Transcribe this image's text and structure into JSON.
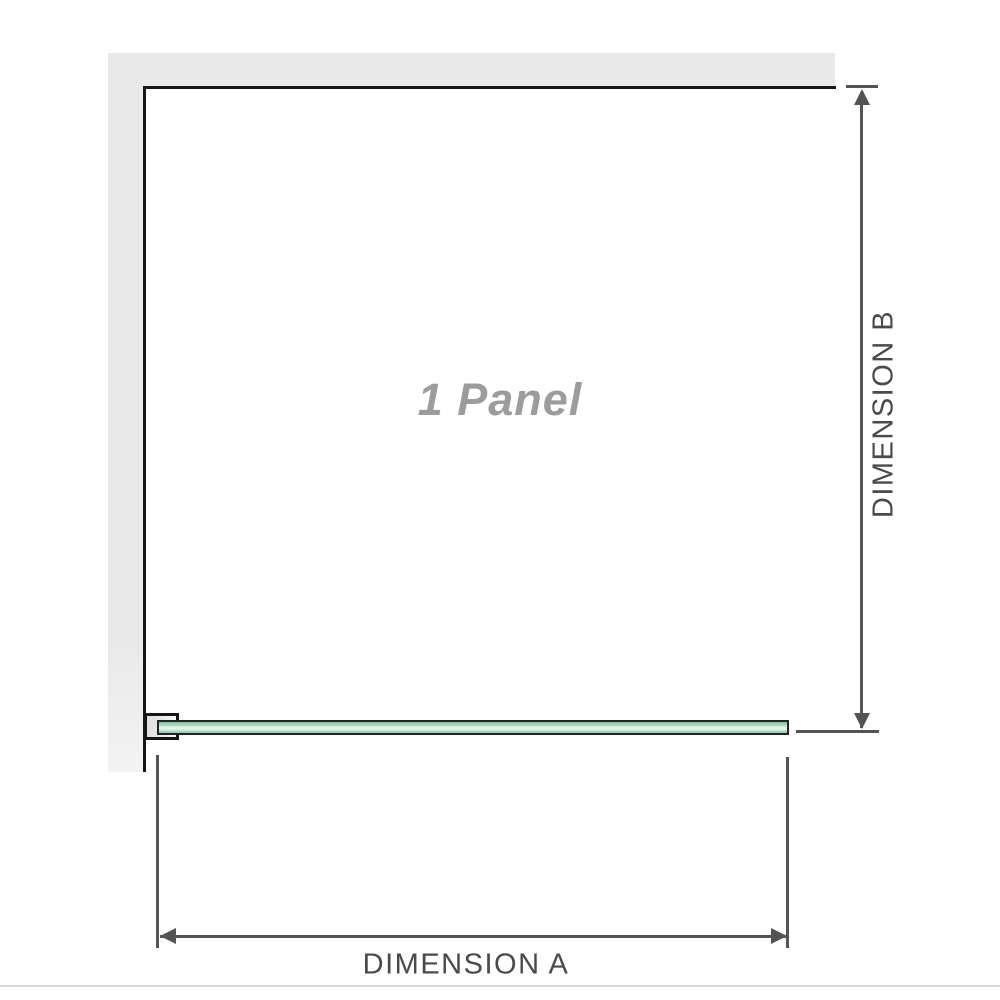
{
  "diagram": {
    "panel_label": "1 Panel",
    "dimension_a_label": "DIMENSION A",
    "dimension_b_label": "DIMENSION B"
  },
  "colors": {
    "canvas-bg": "#ffffff",
    "wall-fill": "#e9e9e9",
    "outline": "#161616",
    "dim-line": "#545454",
    "dim-text": "#4a4a4a",
    "panel-label": "#9c9c9c",
    "glass-border": "#242424",
    "glass-green-dark": "#83c5a1",
    "glass-green-light": "#e9f6ee",
    "glass-green-mid": "#a5d8bb",
    "bracket-fill": "#dedede",
    "bottom-rule": "#d9d9d9"
  }
}
